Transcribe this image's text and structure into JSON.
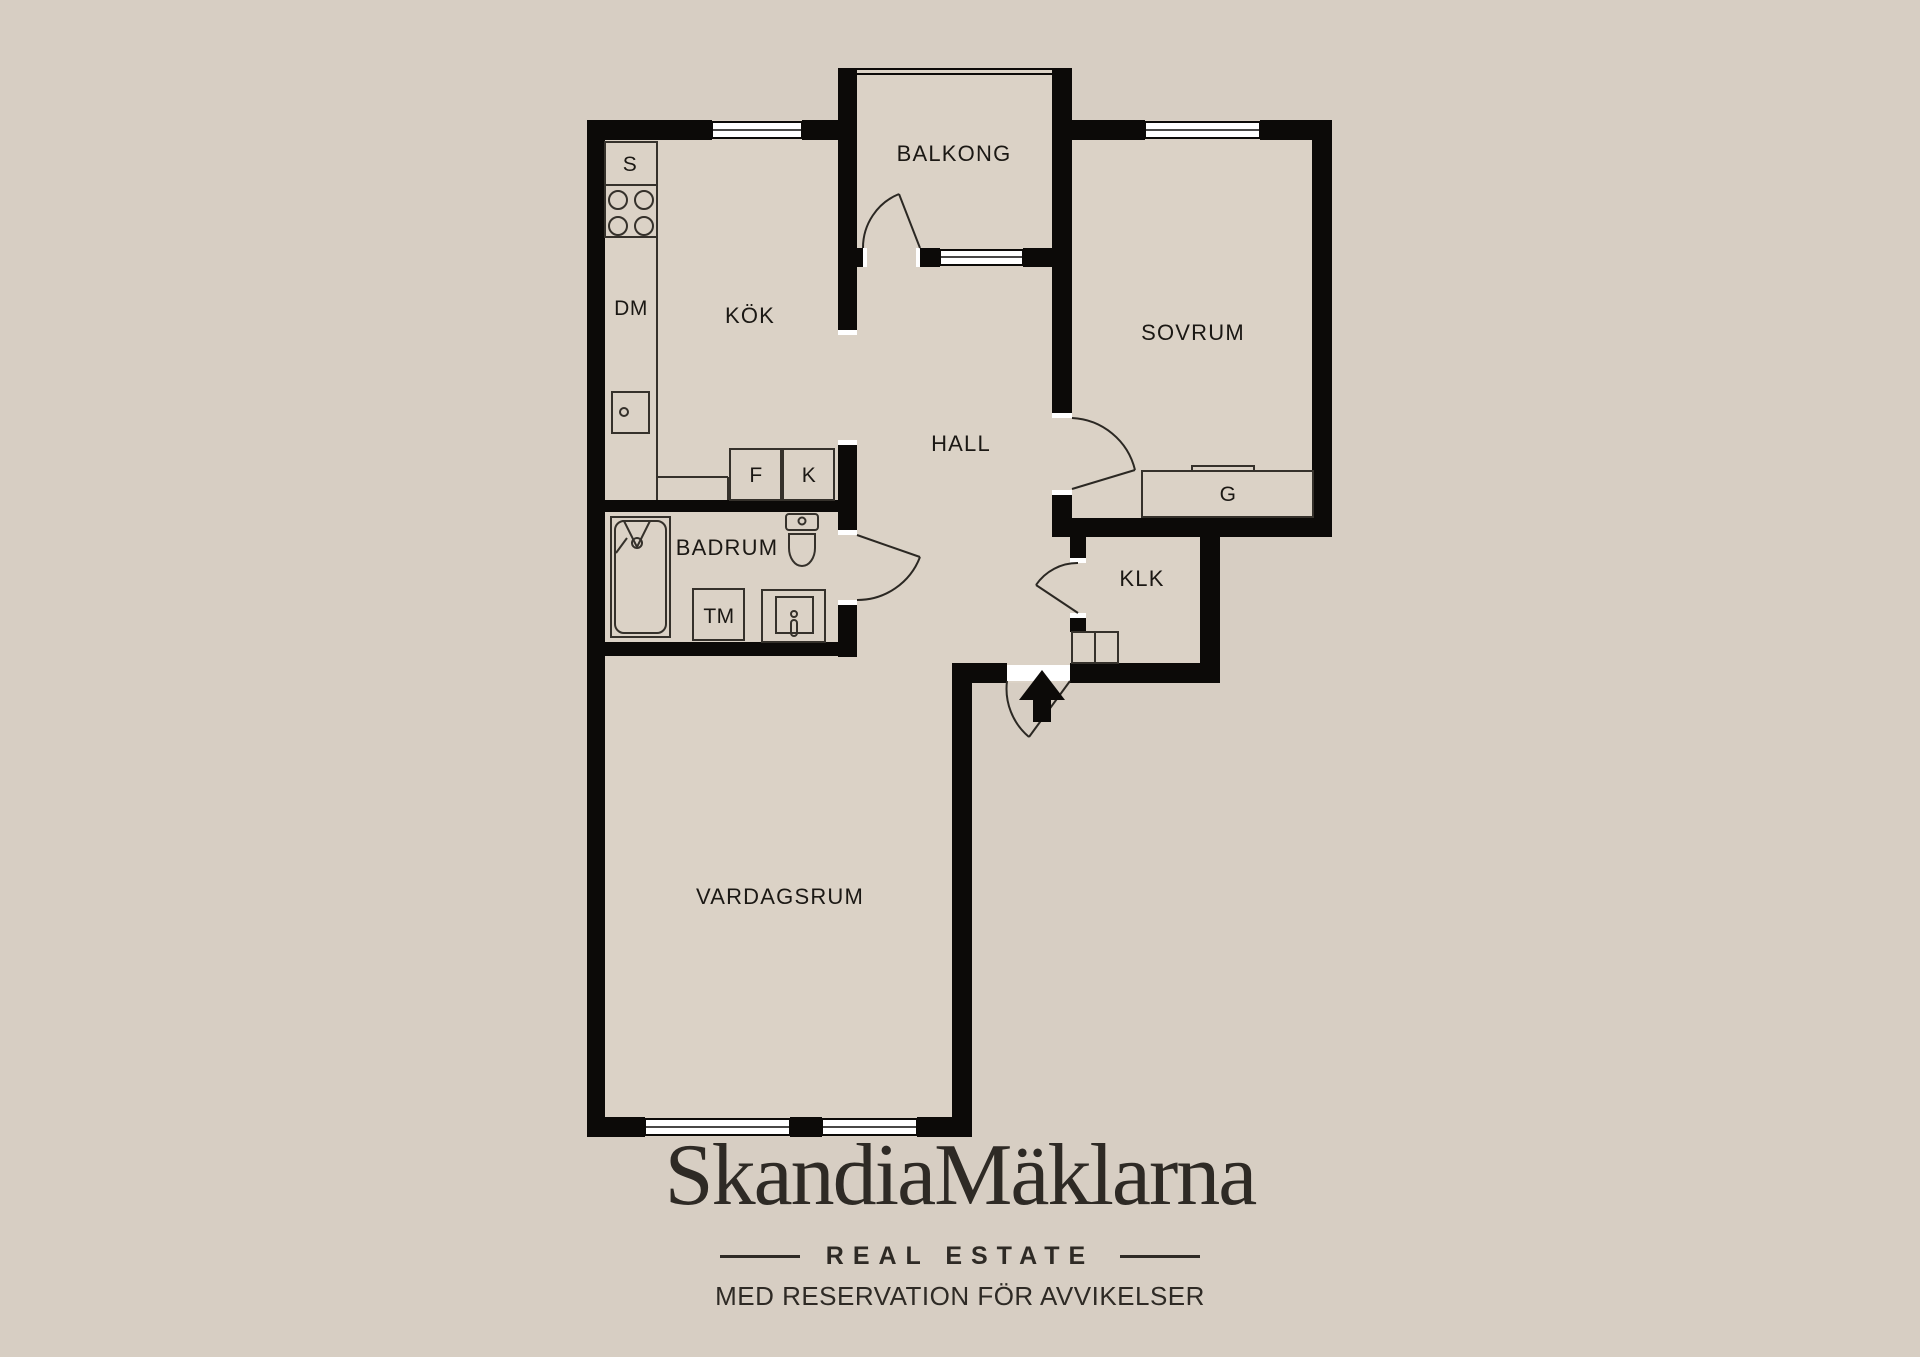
{
  "colors": {
    "background": "#d7cec3",
    "floor": "#dbd2c6",
    "wall": "#0c0a08",
    "fixture_stroke": "#35312b",
    "text": "#1b1814",
    "logo_text": "#2e2a25"
  },
  "floorplan": {
    "rooms": [
      {
        "id": "balkong",
        "label": "BALKONG"
      },
      {
        "id": "kok",
        "label": "KÖK"
      },
      {
        "id": "sovrum",
        "label": "SOVRUM"
      },
      {
        "id": "hall",
        "label": "HALL"
      },
      {
        "id": "badrum",
        "label": "BADRUM"
      },
      {
        "id": "klk",
        "label": "KLK"
      },
      {
        "id": "vardagsrum",
        "label": "VARDAGSRUM"
      }
    ],
    "fixtures": {
      "pantry": "S",
      "dishwasher": "DM",
      "freezer": "F",
      "fridge": "K",
      "wardrobe": "G",
      "washing_machine": "TM"
    }
  },
  "branding": {
    "logo_text": "SkandiaMäklarna",
    "tagline": "REAL ESTATE",
    "disclaimer": "MED RESERVATION FÖR AVVIKELSER"
  }
}
